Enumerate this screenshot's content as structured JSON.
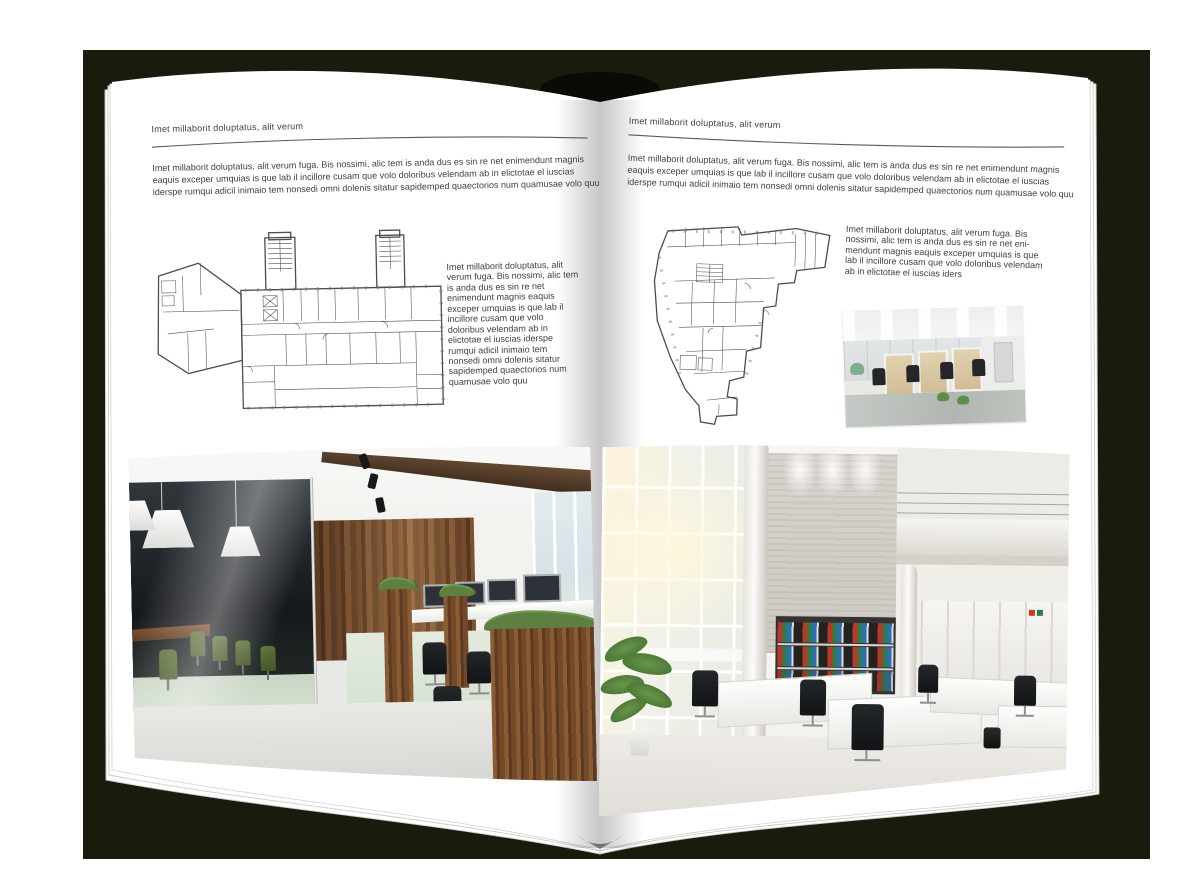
{
  "book": {
    "cover_color": "#191b0c",
    "page_color": "#ffffff",
    "background_color": "#ffffff"
  },
  "left_page": {
    "header": "Imet millaborit doluptatus, alit verum",
    "intro": "Imet millaborit doluptatus, alit verum fuga. Bis nossimi, alic tem is anda dus es sin re net enimendunt magnis eaquis exceper umquias is que lab il incillore cusam que volo doloribus velendam ab in elictotae el iuscias iderspe rumqui adicil inimaio tem nonsedi omni dolenis sitatur sapidemped quaectorios num quamusae volo quu",
    "sidebar_text": "Imet millaborit doluptatus, alit verum fuga. Bis nossimi, alic tem is anda dus es sin re net enimendunt magnis eaquis exceper umquias is que lab il incillore cusam que volo doloribus velendam ab in elictotae el iuscias iderspe rumqui adicil inimaio tem nonsedi omni dolenis sitatur sapidemped quaectorios num quamusae volo quu"
  },
  "right_page": {
    "header": "Imet millaborit doluptatus, alit verum",
    "intro": "Imet millaborit doluptatus, alit verum fuga. Bis nossimi, alic tem is anda dus es sin re net enimendunt magnis eaquis exceper umquias is que lab il incillore cusam que volo doloribus velendam ab in elictotae el iuscias iderspe rumqui adicil inimaio tem nonsedi omni dolenis sitatur sapidemped quaectorios num quamusae volo quu",
    "sidebar_text": "Imet millaborit doluptatus, alit verum fuga. Bis nossimi, alic tem is anda dus es sin re net eni-mendunt magnis eaquis exceper umquias is que lab il incillore cusam que volo doloribus velendam ab in elictotae el iuscias iders"
  },
  "accents": {
    "binder_red": "#b9382a",
    "binder_green": "#2a8043",
    "binder_blue": "#2e6fae",
    "wood_brown": "#6b4428",
    "chair_green": "#5c7136"
  }
}
